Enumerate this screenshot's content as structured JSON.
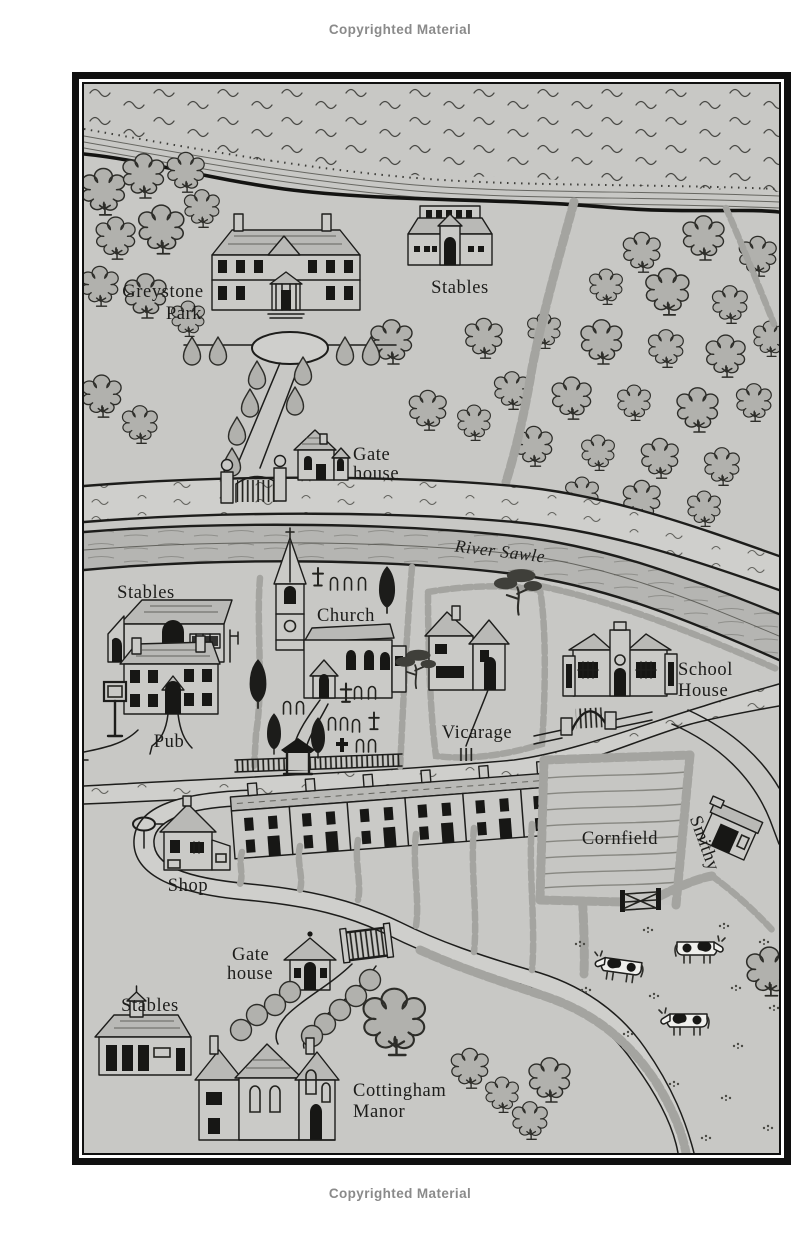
{
  "page": {
    "copyright_top": "Copyrighted Material",
    "copyright_bottom": "Copyrighted Material"
  },
  "map": {
    "labels": {
      "greystone_park": {
        "line1": "Greystone",
        "line2": "Park"
      },
      "stables_north": "Stables",
      "gate_house_north": {
        "line1": "Gate",
        "line2": "house"
      },
      "river": "River Sawle",
      "stables_west": "Stables",
      "church": "Church",
      "pub": "Pub",
      "vicarage": "Vicarage",
      "school_house": {
        "line1": "School",
        "line2": "House"
      },
      "shop": "Shop",
      "cornfield": "Cornfield",
      "smithy": "Smithy",
      "gate_house_south": {
        "line1": "Gate",
        "line2": "house"
      },
      "stables_south": "Stables",
      "cottingham_manor": {
        "line1": "Cottingham",
        "line2": "Manor"
      }
    },
    "colors": {
      "paper": "#c8c8c5",
      "ink": "#1d1d1b",
      "road": "#cfcfcc",
      "water": "#b5b5b2",
      "foliage": "#b1b1ad",
      "hedge": "#a4a4a0",
      "copyright": "#8a8a8a"
    }
  }
}
